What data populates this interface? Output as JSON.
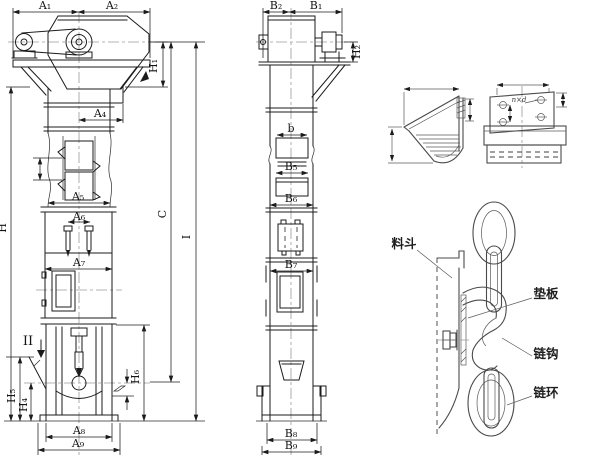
{
  "front_view": {
    "dim_a1": "A₁",
    "dim_a2": "A₂",
    "dim_a4": "A₄",
    "dim_a5": "A₅",
    "dim_a6": "A₆",
    "dim_a7": "A₇",
    "dim_a8": "A₈",
    "dim_a9": "A₉",
    "dim_h": "H",
    "dim_h1": "H₁",
    "dim_h4": "H₄",
    "dim_h5": "H₅",
    "dim_h6": "H₆",
    "section_marker": "II"
  },
  "side_view": {
    "dim_b2": "B₂",
    "dim_b1": "B₁",
    "dim_b": "b",
    "dim_b5": "B₅",
    "dim_b6": "B₆",
    "dim_b7": "B₇",
    "dim_b8": "B₈",
    "dim_b9": "B₉",
    "dim_h2": "H₂",
    "dim_c": "C",
    "dim_i": "I"
  },
  "details": {
    "plate_holes_label": "n×d",
    "bucket_label": "料斗",
    "pad_label": "垫板",
    "hook_label": "链钩",
    "ring_label": "链环"
  }
}
